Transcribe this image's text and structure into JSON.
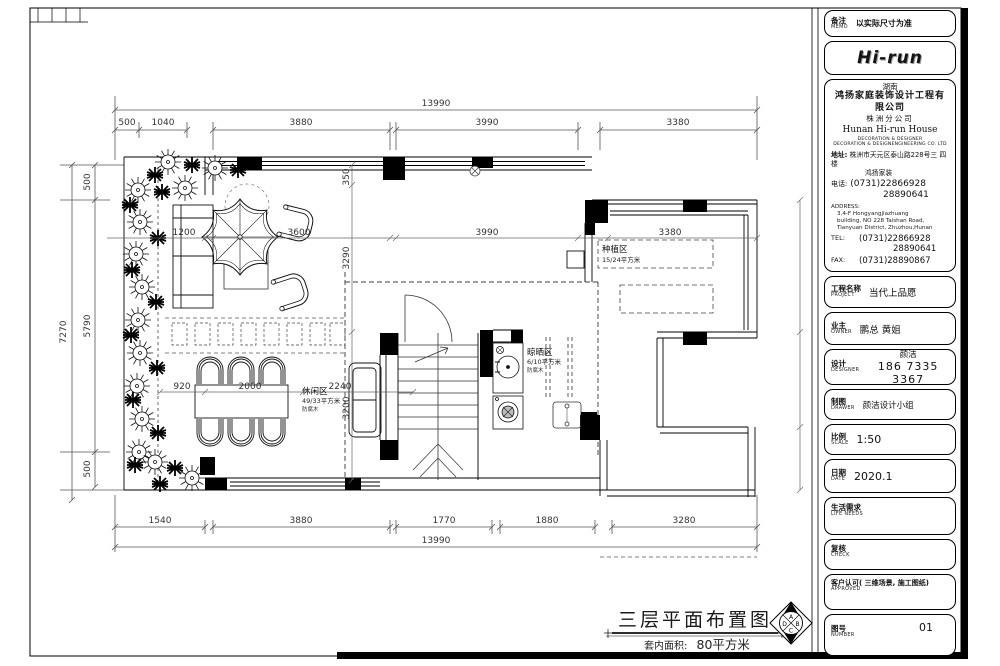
{
  "title_block": {
    "memo": {
      "label": "备注",
      "label_en": "MEMO",
      "value": "以实际尺寸为准"
    },
    "logo_text": "Hi-run",
    "company": {
      "region": "湖南",
      "name": "鸿扬家庭装饰设计工程有限公司",
      "branch": "株洲分公司",
      "name_en": "Hunan  Hi-run  House",
      "tagline1": "DECORATION & DESIGNER",
      "tagline2": "DECORATION & DESIGNENGINEERING CO. LTD",
      "addr_label": "地址:",
      "addr_line1": "株洲市天元区泰山路228号三 四楼",
      "addr_line2": "鸿扬家装",
      "phone_label": "电话:",
      "phone1": "(0731)22866928",
      "phone2": "28890641",
      "address_en_label": "ADDRESS:",
      "address_en_line1": "3,4-F Hongyangjiazhuang",
      "address_en_line2": "building, NO 228 Taishan Road,",
      "address_en_line3": "Tianyuan District, Zhuzhou,Hunan",
      "tel_label": "TEL:",
      "tel1": "(0731)22866928",
      "tel2": "28890641",
      "fax_label": "FAX:",
      "fax": "(0731)28890867"
    },
    "rows": {
      "project": {
        "label": "工程名称",
        "label_en": "PROJECT",
        "value": "当代上品愿"
      },
      "owner": {
        "label": "业主",
        "label_en": "OWNER",
        "value": "鹏总  黄姐"
      },
      "designer": {
        "label": "设计",
        "label_en": "DESIGNER",
        "name": "颜洁",
        "phone": "186  7335  3367"
      },
      "drawer": {
        "label": "制图",
        "label_en": "DRAWER",
        "value": "颜洁设计小组"
      },
      "scale": {
        "label": "比例",
        "label_en": "SCALE",
        "value": "1:50"
      },
      "date": {
        "label": "日期",
        "label_en": "DATE",
        "value": "2020.1"
      },
      "life": {
        "label": "生活需求",
        "label_en": "LIFE  NEEDS",
        "value": ""
      },
      "check": {
        "label": "复核",
        "label_en": "CHECK",
        "value": ""
      },
      "approved": {
        "label": "客户认可( 三维场景, 施工图纸)",
        "label_en": "APPROVED",
        "value": ""
      },
      "number": {
        "label": "图号",
        "label_en": "NUMBER",
        "value": "01"
      }
    }
  },
  "plan": {
    "dims": {
      "top_total": "13990",
      "top": [
        "500",
        "1040",
        "3880",
        "3990",
        "3380"
      ],
      "bottom": [
        "1540",
        "3880",
        "1770",
        "1880",
        "3280"
      ],
      "bottom_total": "13990",
      "left_total": "7270",
      "left": [
        "500",
        "5790",
        "500"
      ],
      "inner_row1": [
        "1200",
        "3600",
        "3990",
        "3380"
      ],
      "inner_row2": [
        "920",
        "2000",
        "2240"
      ],
      "inner_col": [
        "350",
        "3290",
        "3200"
      ]
    },
    "areas": {
      "leisure": {
        "name": "休闲区",
        "area": "49/33平方米",
        "material": "防腐木"
      },
      "drying": {
        "name": "晾晒区",
        "area": "6/10平方米",
        "material": "防腐木"
      },
      "planting": {
        "name": "种植区",
        "area": "15/24平方米"
      }
    },
    "drawing_title": {
      "main": "三层平面布置图",
      "area_label": "套内面积:",
      "area_value": "80平方米"
    },
    "compass": {
      "top": "A",
      "right": "B",
      "bottom": "C",
      "left": "D"
    }
  }
}
